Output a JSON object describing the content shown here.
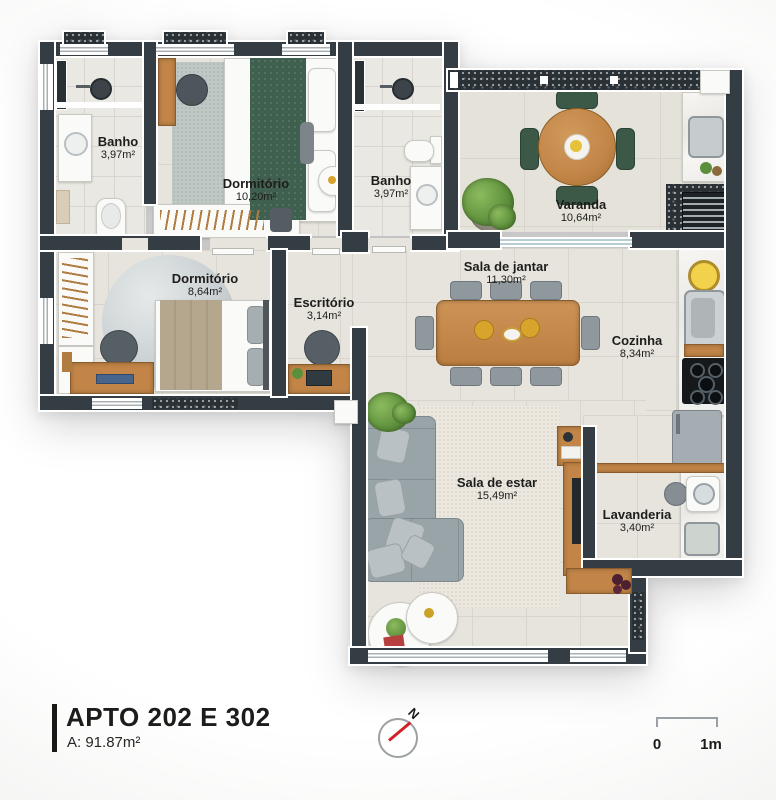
{
  "legend": {
    "title": "APTO 202 E 302",
    "area": "A: 91.87m²"
  },
  "compass": {
    "north_label": "N"
  },
  "scale_bar": {
    "start_label": "0",
    "end_label": "1m"
  },
  "rooms": {
    "banho_1": {
      "name": "Banho",
      "area": "3,97m²"
    },
    "dormitorio_1": {
      "name": "Dormitório",
      "area": "10,20m²"
    },
    "banho_2": {
      "name": "Banho",
      "area": "3,97m²"
    },
    "varanda": {
      "name": "Varanda",
      "area": "10,64m²"
    },
    "dormitorio_2": {
      "name": "Dormitório",
      "area": "8,64m²"
    },
    "escritorio": {
      "name": "Escritório",
      "area": "3,14m²"
    },
    "sala_de_jantar": {
      "name": "Sala de jantar",
      "area": "11,30m²"
    },
    "cozinha": {
      "name": "Cozinha",
      "area": "8,34m²"
    },
    "sala_de_estar": {
      "name": "Sala de estar",
      "area": "15,49m²"
    },
    "lavanderia": {
      "name": "Lavanderia",
      "area": "3,40m²"
    }
  },
  "colors": {
    "wall": "#343d44",
    "floor": "#e7e4dd",
    "wood": "#c28547",
    "sofa": "#99a4a9",
    "outdoor_chair": "#3c5948",
    "bed_blanket_green": "#40604f",
    "compass_needle": "#d32027",
    "label_text": "#1d1d1b"
  }
}
